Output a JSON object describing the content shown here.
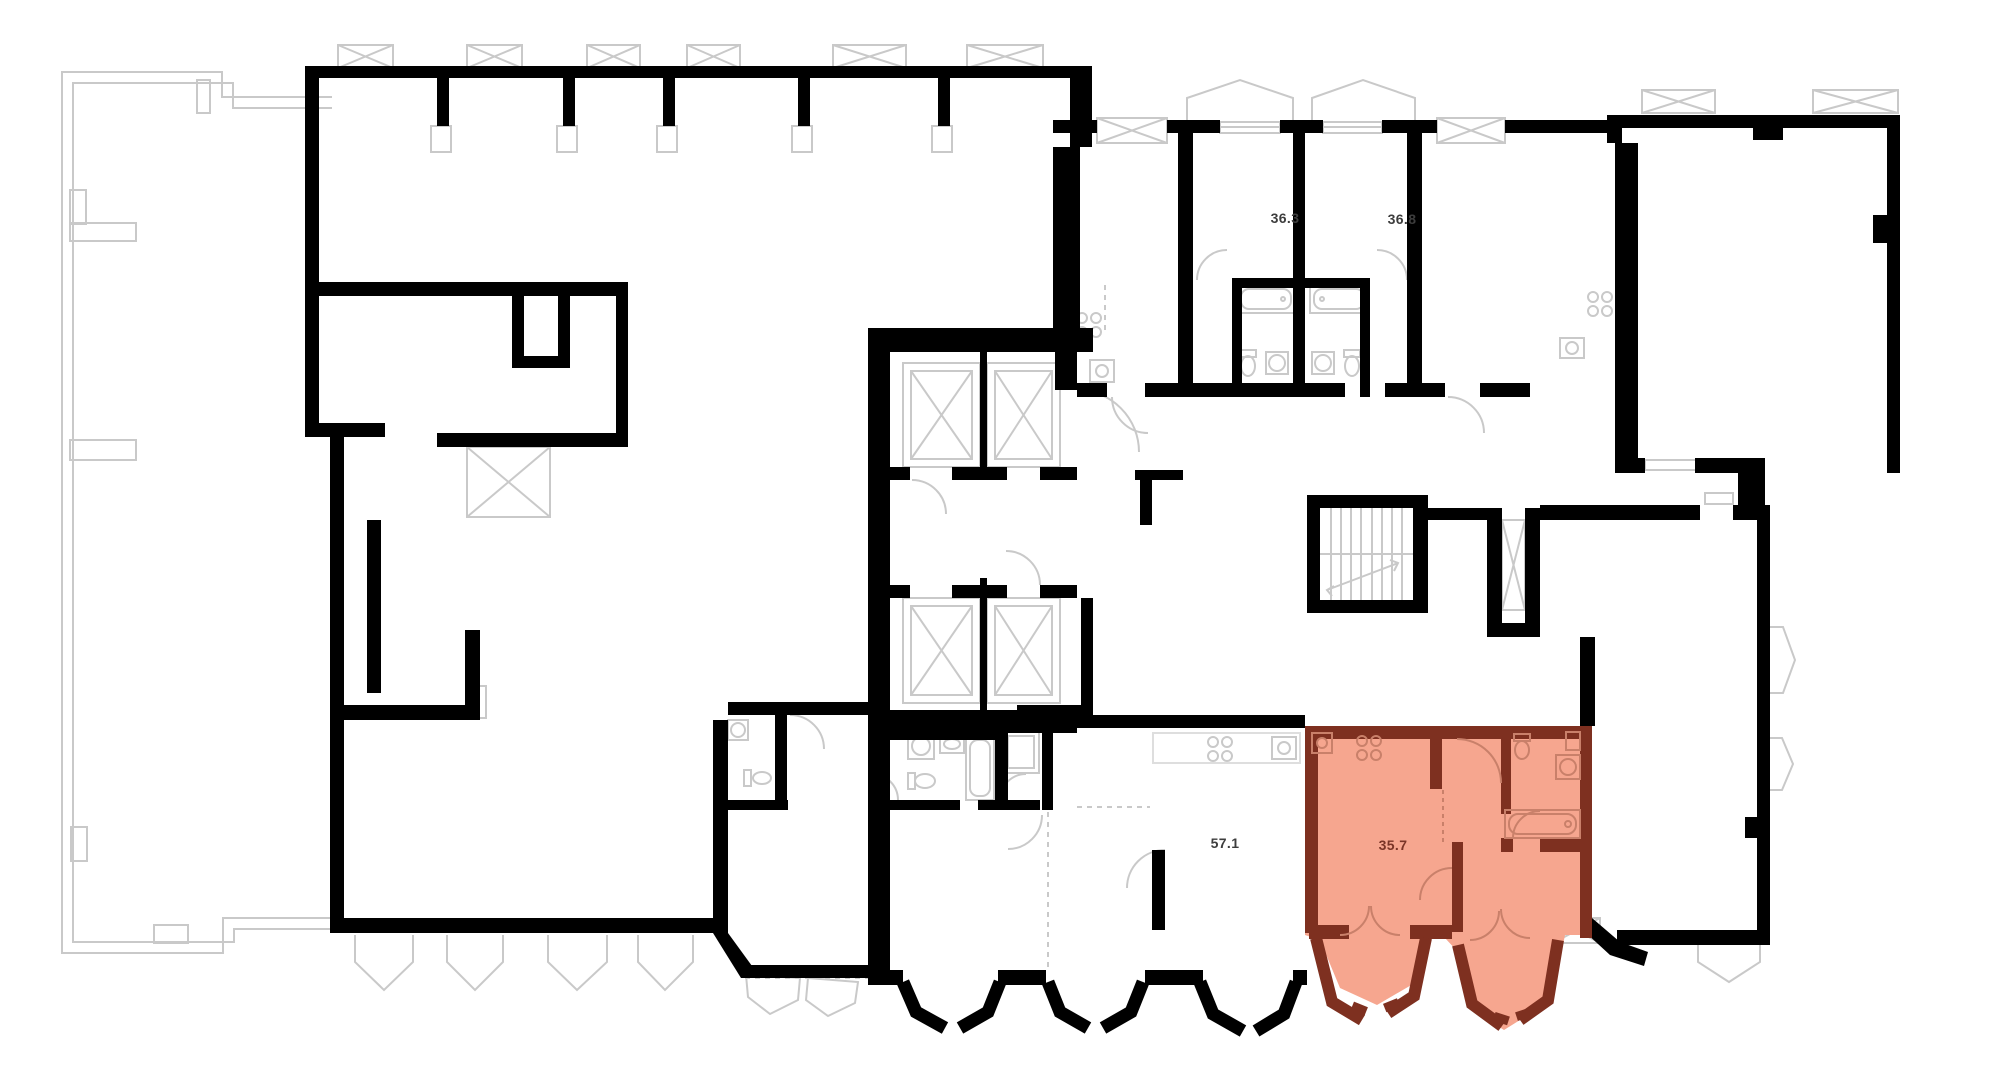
{
  "plan": {
    "units": [
      {
        "id": "unit-36-3",
        "area_label": "36.3",
        "highlighted": false
      },
      {
        "id": "unit-36-8",
        "area_label": "36.8",
        "highlighted": false
      },
      {
        "id": "unit-57-1",
        "area_label": "57.1",
        "highlighted": false
      },
      {
        "id": "unit-35-7",
        "area_label": "35.7",
        "highlighted": true
      }
    ],
    "colors": {
      "background": "#ffffff",
      "wall": "#000000",
      "outline_gray": "#c9c9c9",
      "outline_light": "#dcdcdc",
      "highlight_fill": "#f6a68f",
      "highlight_wall": "#7e3020",
      "highlight_detail": "#c9806a",
      "label_gray": "#3d3d3d",
      "label_highlight": "#7a3527"
    }
  }
}
